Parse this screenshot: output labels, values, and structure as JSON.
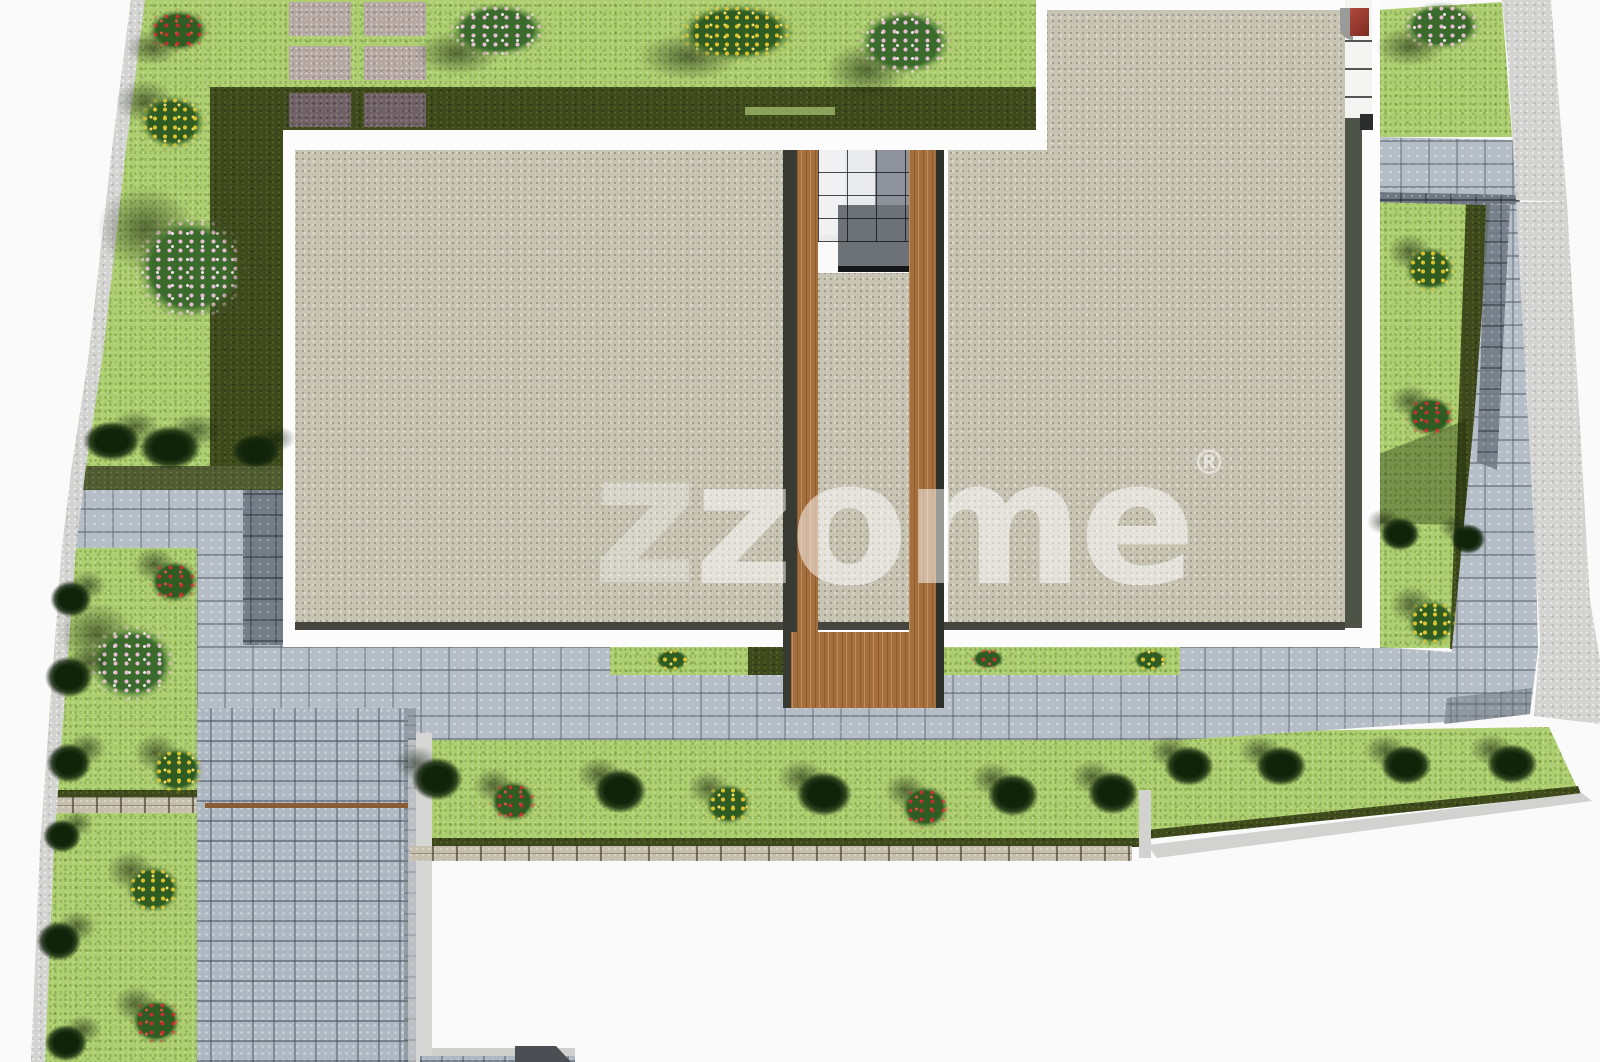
{
  "watermark": {
    "z": "z",
    "rest": "zome",
    "mark": "®"
  },
  "palette": {
    "bg": "#fafafa",
    "white_trim": "#fcfcfc",
    "lawn": "#aecf70",
    "hedge": "#3e4a1c",
    "bush_green": "#2f5c22",
    "flower_red": "#c72f2f",
    "flower_yellow": "#dfc22c",
    "flower_pink": "#e8bed4",
    "roof": "#c8c4b4",
    "roof_line": "#46463f",
    "cobble": "#b5bec7",
    "cobble_dark": "#6f7882",
    "drive": "#aeb8c2",
    "sidewalk": "#d3d3d1",
    "rubble": "#c6bfad",
    "slab": "#b5a8a3",
    "slab_shadow": "#6f6165",
    "wood": "#a56f3d",
    "brown_line": "#8a5c33",
    "glass_light": "#e9eaec",
    "glass_dark": "#8e939b",
    "landing": "#6d7276",
    "chimney_red": "#9c372d",
    "watermark_color": "rgba(255,255,255,0.52)",
    "watermark_faint": "rgba(255,255,255,0.30)"
  }
}
